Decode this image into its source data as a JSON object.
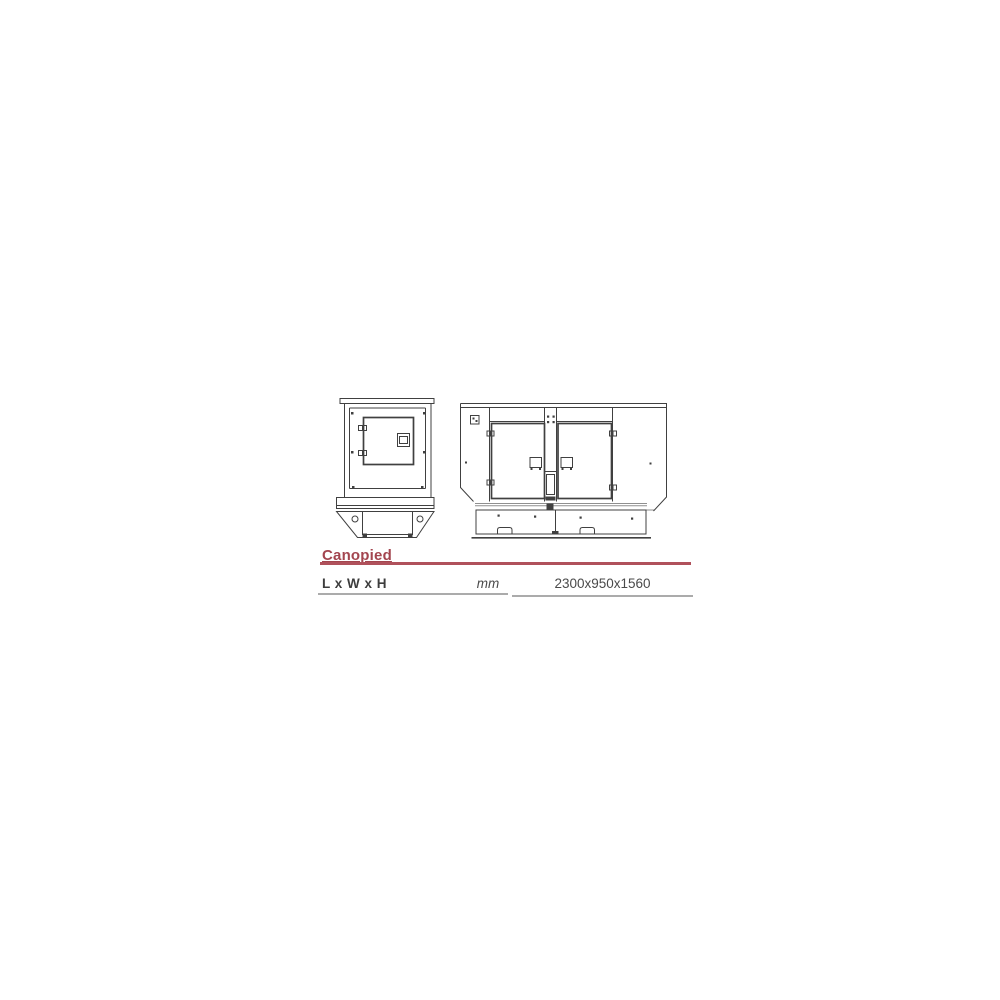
{
  "page": {
    "background_color": "#ffffff"
  },
  "product_section": {
    "heading": {
      "label": "Canopied",
      "text_color": "#a3454f",
      "rule_color": "#b0515b"
    },
    "spec_table": {
      "row": {
        "label": "L x W x H",
        "unit": "mm",
        "value": "2300x950x1560"
      },
      "label_color": "#3d3d3d",
      "value_color": "#4a4a4a",
      "rule_color": "#ababab"
    }
  },
  "drawings": {
    "line_color": "#404040",
    "light_line_color": "#8f8f8f",
    "front_view": {
      "name": "generator-canopy-front-view"
    },
    "side_view": {
      "name": "generator-canopy-side-view"
    }
  }
}
